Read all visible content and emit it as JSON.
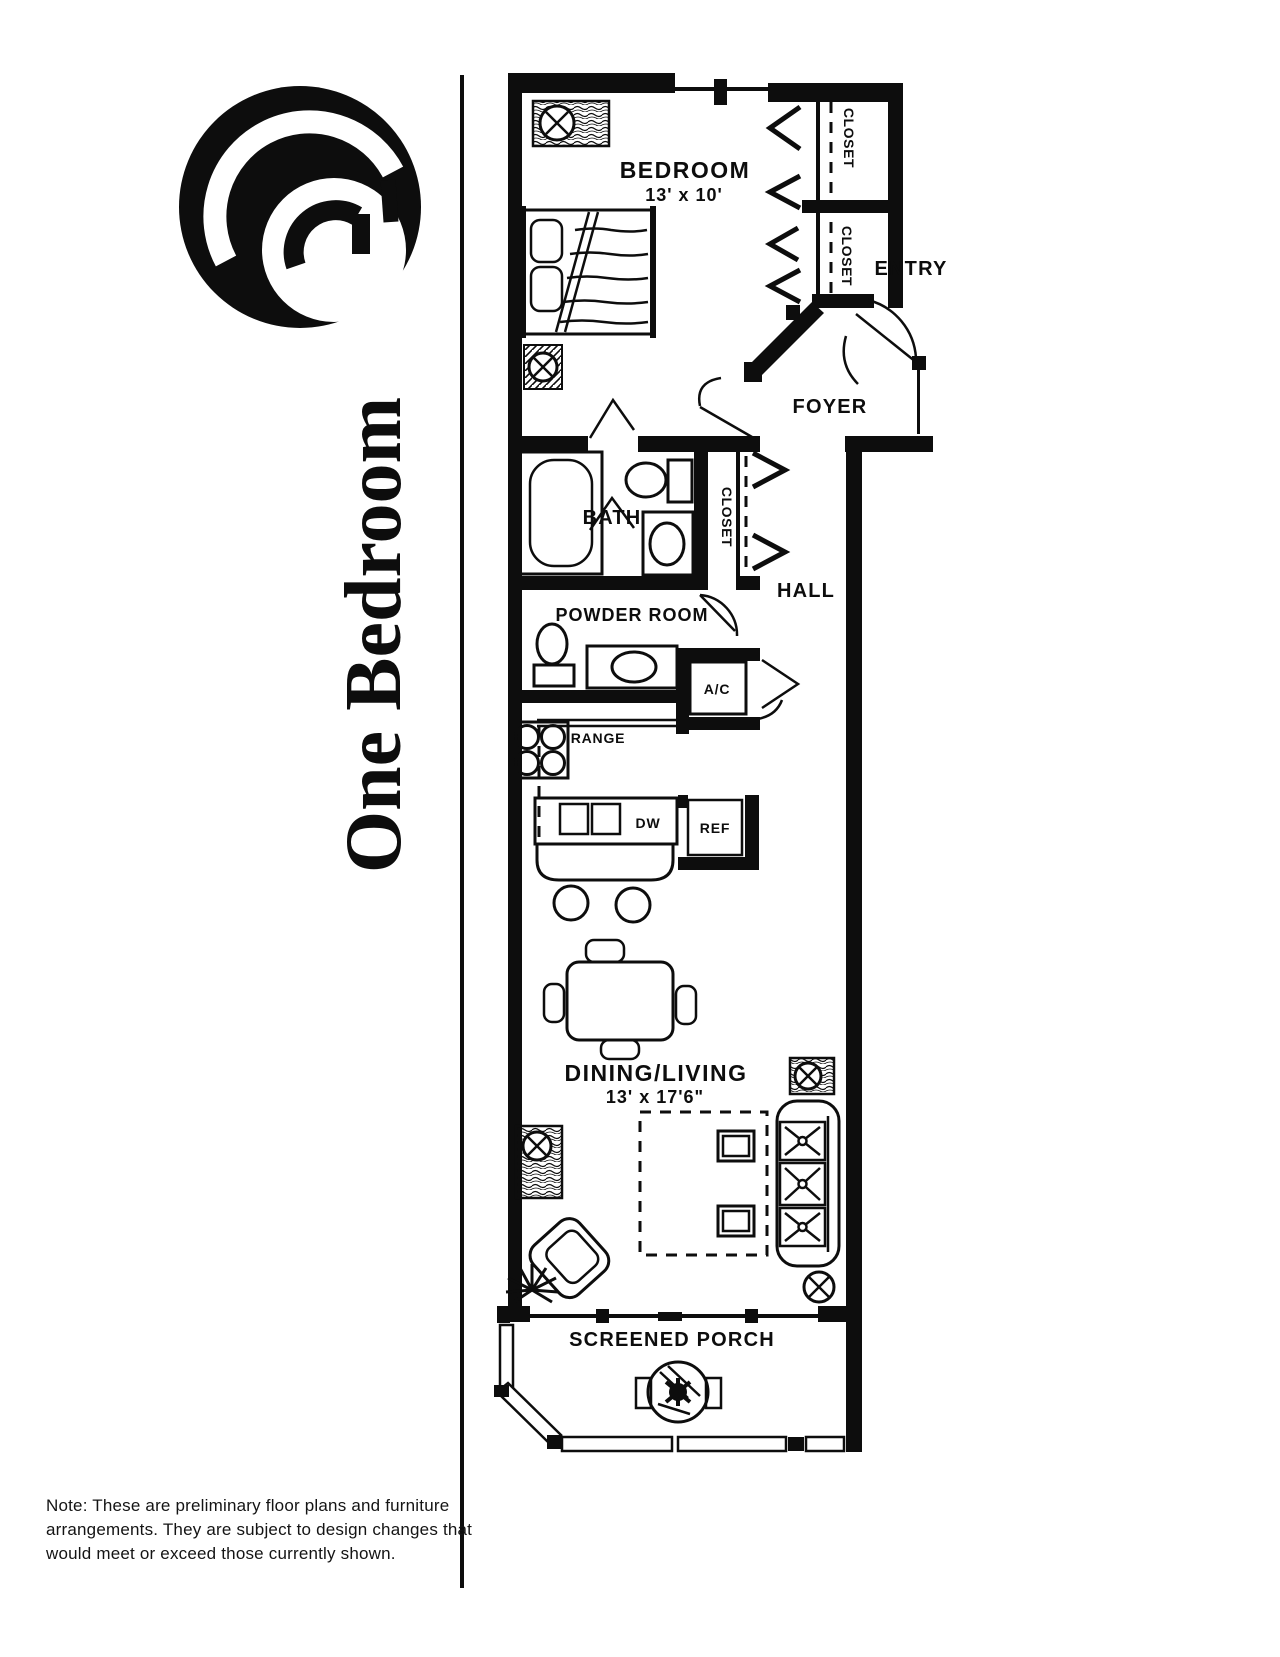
{
  "sidebar": {
    "title": "One Bedroom"
  },
  "plan": {
    "bedroom": {
      "label": "BEDROOM",
      "size": "13' x 10'"
    },
    "closet_top": {
      "label": "CLOSET"
    },
    "closet_mid": {
      "label": "CLOSET"
    },
    "closet_hall": {
      "label": "CLOSET"
    },
    "entry": {
      "label": "ENTRY"
    },
    "foyer": {
      "label": "FOYER"
    },
    "bath": {
      "label": "BATH"
    },
    "hall": {
      "label": "HALL"
    },
    "powder_room": {
      "label": "POWDER ROOM"
    },
    "ac": {
      "label": "A/C"
    },
    "range": {
      "label": "RANGE"
    },
    "dishwasher": {
      "label": "DW"
    },
    "refrigerator": {
      "label": "REF"
    },
    "dining_living": {
      "label": "DINING/LIVING",
      "size": "13' x 17'6\""
    },
    "screened_porch": {
      "label": "SCREENED PORCH"
    }
  },
  "note": {
    "text": "Note: These are preliminary floor plans and furniture arrangements. They are subject to design changes that would meet or exceed those currently shown."
  },
  "colors": {
    "ink": "#0d0d0d",
    "paper": "#ffffff"
  },
  "icons": {
    "logo": "wave-swirl-logo",
    "fixture": "circle-x-ceiling-fixture",
    "closet_doors": "bifold-chevron",
    "plant": "starburst-plant"
  }
}
